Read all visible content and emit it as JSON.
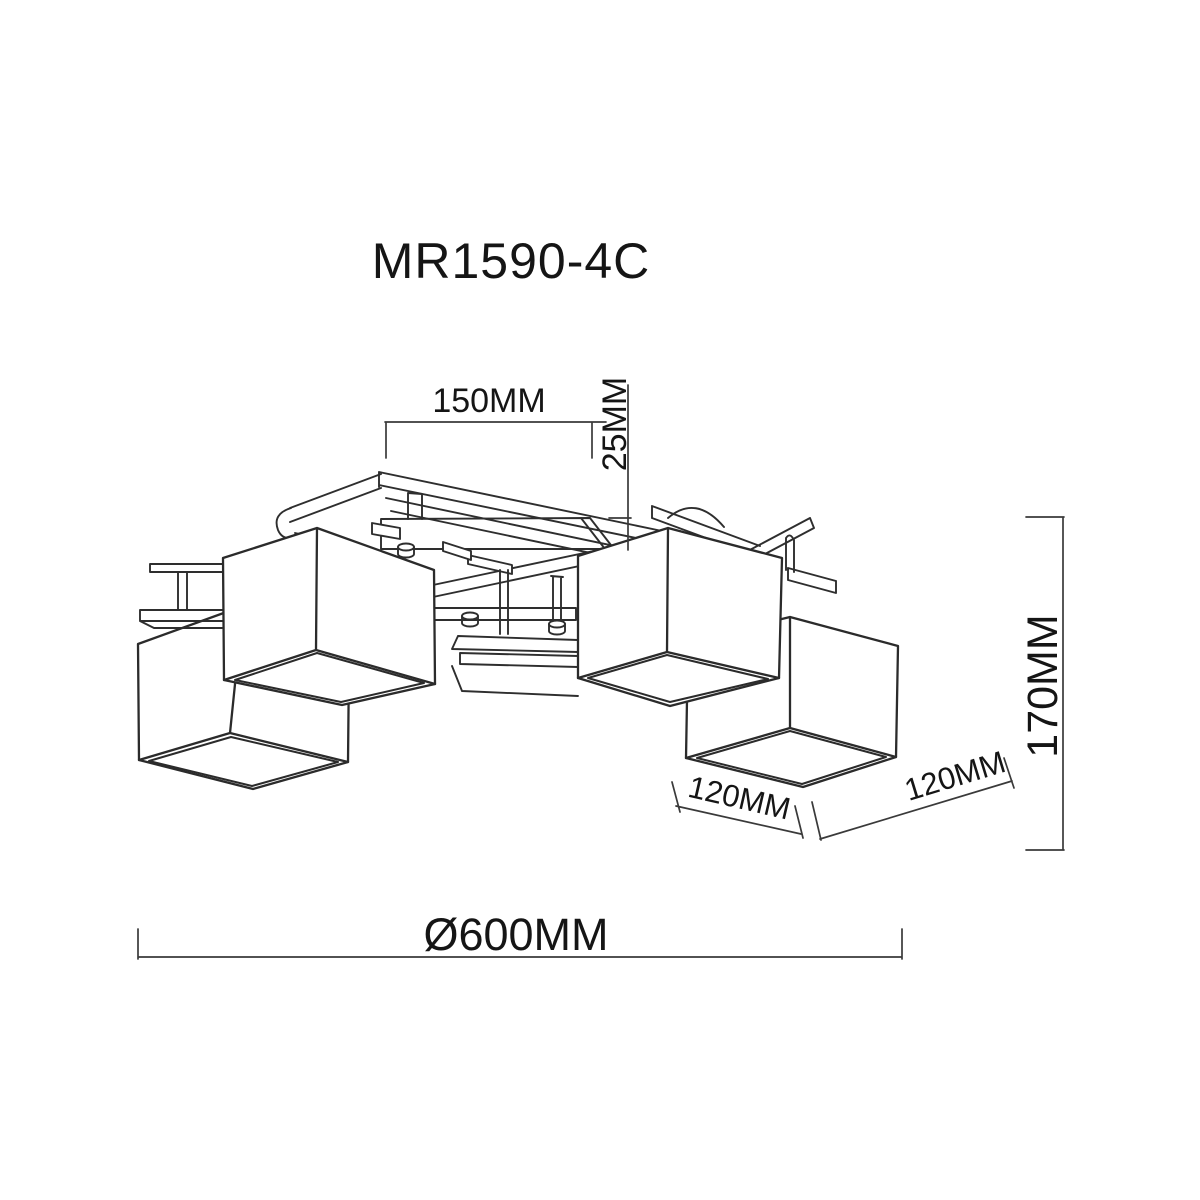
{
  "title": "MR1590-4C",
  "dimensions": {
    "arm_spacing": "150MM",
    "canopy_offset": "25MM",
    "fixture_height": "170MM",
    "shade_width_left": "120MM",
    "shade_width_right": "120MM",
    "overall_diameter": "Ø600MM"
  }
}
